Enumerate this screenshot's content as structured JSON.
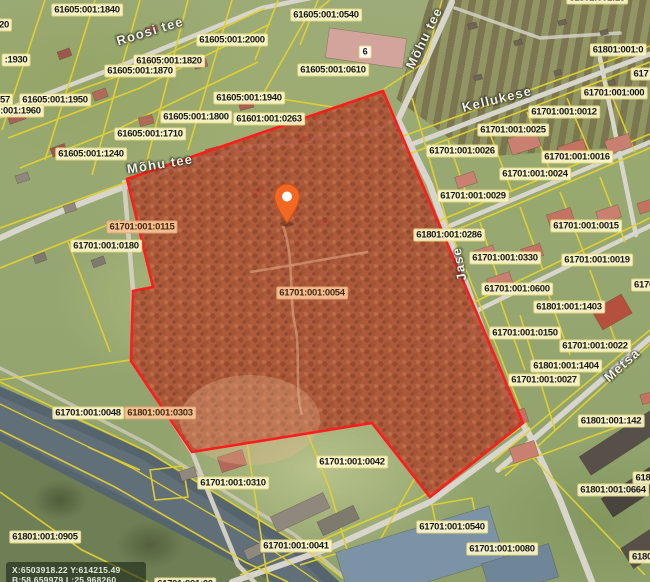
{
  "map": {
    "selected_parcel_id": "61701:001:0054",
    "colors": {
      "cadastral_line": "#e3d22f",
      "selection_outline": "#ff1c1c",
      "pin": "#f26822",
      "road": "#d8d6cc",
      "river": "#5d6b74"
    },
    "overlay": {
      "line1": "X:6503918.22 Y:614215.49",
      "line2": "B:58.659979 L:25.968260"
    },
    "parcel_labels": [
      {
        "t": "61605:001:1840",
        "x": 87,
        "y": 10
      },
      {
        "t": "61605:001:2000",
        "x": 232,
        "y": 40
      },
      {
        "t": "61605:001:1820",
        "x": 169,
        "y": 61
      },
      {
        "t": "61605:001:1870",
        "x": 140,
        "y": 71
      },
      {
        "t": ":1930",
        "x": 16,
        "y": 60
      },
      {
        "t": "20",
        "x": 4,
        "y": 25
      },
      {
        "t": "57",
        "x": 5,
        "y": 100
      },
      {
        "t": "61605:001:1950",
        "x": 55,
        "y": 100
      },
      {
        "t": "61605:001:1960",
        "x": 8,
        "y": 111
      },
      {
        "t": "61605:001:1940",
        "x": 249,
        "y": 98
      },
      {
        "t": "61605:001:1800",
        "x": 196,
        "y": 117
      },
      {
        "t": "61601:001:0263",
        "x": 269,
        "y": 119
      },
      {
        "t": "61605:001:1710",
        "x": 150,
        "y": 134
      },
      {
        "t": "61605:001:1240",
        "x": 91,
        "y": 154
      },
      {
        "t": "61605:001:0540",
        "x": 326,
        "y": 15
      },
      {
        "t": "61605:001:0610",
        "x": 333,
        "y": 70
      },
      {
        "t": "6",
        "x": 365,
        "y": 52,
        "v": "house"
      },
      {
        "t": "61801:001:18",
        "x": 597,
        "y": -2
      },
      {
        "t": "61801:001:0",
        "x": 618,
        "y": 50
      },
      {
        "t": "617",
        "x": 641,
        "y": 74
      },
      {
        "t": "61701:001:000",
        "x": 614,
        "y": 93
      },
      {
        "t": "61701:001:0012",
        "x": 564,
        "y": 112
      },
      {
        "t": "61701:001:0025",
        "x": 513,
        "y": 130
      },
      {
        "t": "61701:001:0026",
        "x": 462,
        "y": 151
      },
      {
        "t": "61701:001:0016",
        "x": 577,
        "y": 157
      },
      {
        "t": "61701:001:0024",
        "x": 535,
        "y": 174
      },
      {
        "t": "61701:001:0029",
        "x": 473,
        "y": 196
      },
      {
        "t": "61701:001:0015",
        "x": 586,
        "y": 226
      },
      {
        "t": "61801:001:0286",
        "x": 449,
        "y": 235
      },
      {
        "t": "61701:001:0330",
        "x": 505,
        "y": 258
      },
      {
        "t": "61701:001:0019",
        "x": 597,
        "y": 260
      },
      {
        "t": "6170",
        "x": 644,
        "y": 285
      },
      {
        "t": "61701:001:0600",
        "x": 517,
        "y": 289
      },
      {
        "t": "61801:001:1403",
        "x": 569,
        "y": 307
      },
      {
        "t": "61701:001:0150",
        "x": 525,
        "y": 333
      },
      {
        "t": "61701:001:0022",
        "x": 595,
        "y": 346
      },
      {
        "t": "61801:001:1404",
        "x": 566,
        "y": 366
      },
      {
        "t": "61701:001:0027",
        "x": 544,
        "y": 380
      },
      {
        "t": "61701:001:0115",
        "x": 142,
        "y": 227,
        "v": "onred"
      },
      {
        "t": "61701:001:0180",
        "x": 106,
        "y": 246
      },
      {
        "t": "61701:001:0054",
        "x": 312,
        "y": 293,
        "v": "onred"
      },
      {
        "t": "61701:001:0048",
        "x": 88,
        "y": 413
      },
      {
        "t": "61801:001:0303",
        "x": 160,
        "y": 413,
        "v": "onred"
      },
      {
        "t": "61801:001:142",
        "x": 611,
        "y": 421
      },
      {
        "t": "618",
        "x": 643,
        "y": 478
      },
      {
        "t": "61801:001:0664",
        "x": 613,
        "y": 490
      },
      {
        "t": "61701:001:0310",
        "x": 233,
        "y": 483
      },
      {
        "t": "61701:001:0042",
        "x": 352,
        "y": 462
      },
      {
        "t": "61701:001:0041",
        "x": 296,
        "y": 546
      },
      {
        "t": "61701:001:0540",
        "x": 452,
        "y": 527
      },
      {
        "t": "61701:001:0080",
        "x": 502,
        "y": 549
      },
      {
        "t": "61801:001:0905",
        "x": 45,
        "y": 537
      },
      {
        "t": "6180",
        "x": 642,
        "y": 557
      },
      {
        "t": "61701:001:00",
        "x": 185,
        "y": 584
      }
    ],
    "road_labels": [
      {
        "t": "Roosi tee",
        "x": 150,
        "y": 31,
        "r": -17
      },
      {
        "t": "Mõhu tee",
        "x": 424,
        "y": 38,
        "r": -64
      },
      {
        "t": "Mõhu tee",
        "x": 160,
        "y": 164,
        "r": -9
      },
      {
        "t": "Kellukese",
        "x": 497,
        "y": 99,
        "r": -14
      },
      {
        "t": "Metsa",
        "x": 622,
        "y": 365,
        "r": -42
      },
      {
        "t": "Jase",
        "x": 459,
        "y": 264,
        "r": -100
      }
    ]
  }
}
